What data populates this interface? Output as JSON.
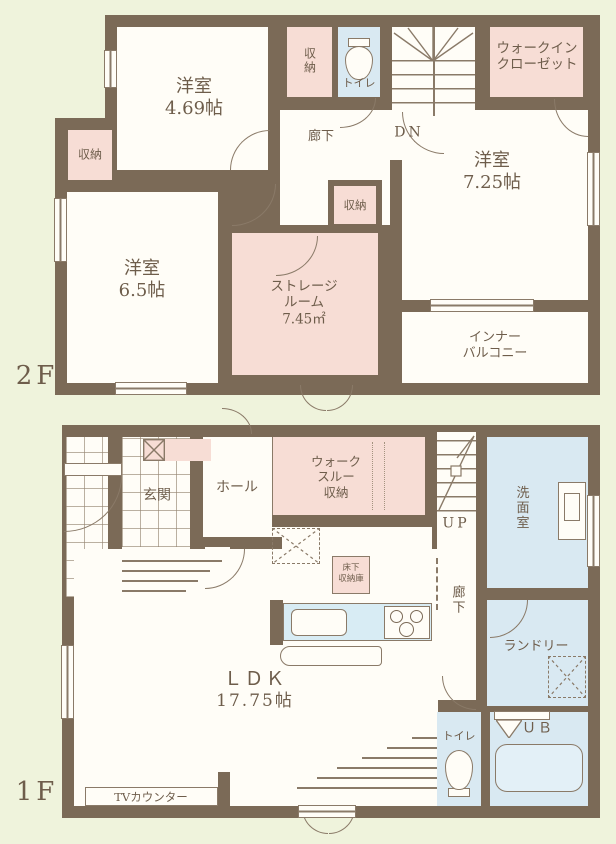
{
  "colors": {
    "background": "#eff3dc",
    "wall": "#7b6a57",
    "closet_pink": "#f7ddd5",
    "wet_blue": "#d9e9f2",
    "paper": "#fffdf7",
    "ink": "#6e5d4b"
  },
  "f2": {
    "floor_label": "2F",
    "r469": {
      "name": "洋室",
      "size": "4.69帖"
    },
    "closet_top": "収納",
    "toilet": "トイレ",
    "stairs_dn": "DN",
    "wic_l1": "ウォークイン",
    "wic_l2": "クローゼット",
    "hallway": "廊下",
    "closet_left": "収納",
    "r65": {
      "name": "洋室",
      "size": "6.5帖"
    },
    "closet_mid": "収納",
    "storage_l1": "ストレージ",
    "storage_l2": "ルーム",
    "storage_l3": "7.45㎡",
    "r725": {
      "name": "洋室",
      "size": "7.25帖"
    },
    "balcony_l1": "インナー",
    "balcony_l2": "バルコニー"
  },
  "f1": {
    "floor_label": "1F",
    "entrance": "玄関",
    "hall": "ホール",
    "wts_l1": "ウォーク",
    "wts_l2": "スルー",
    "wts_l3": "収納",
    "stairs_up": "UP",
    "washroom": "洗面室",
    "hallway": "廊下",
    "underfloor_l1": "床下",
    "underfloor_l2": "収納庫",
    "ldk": {
      "name": "ＬＤＫ",
      "size": "17.75帖"
    },
    "laundry": "ランドリー",
    "toilet": "トイレ",
    "bath": "ＵＢ",
    "tv_counter": "TVカウンター"
  }
}
